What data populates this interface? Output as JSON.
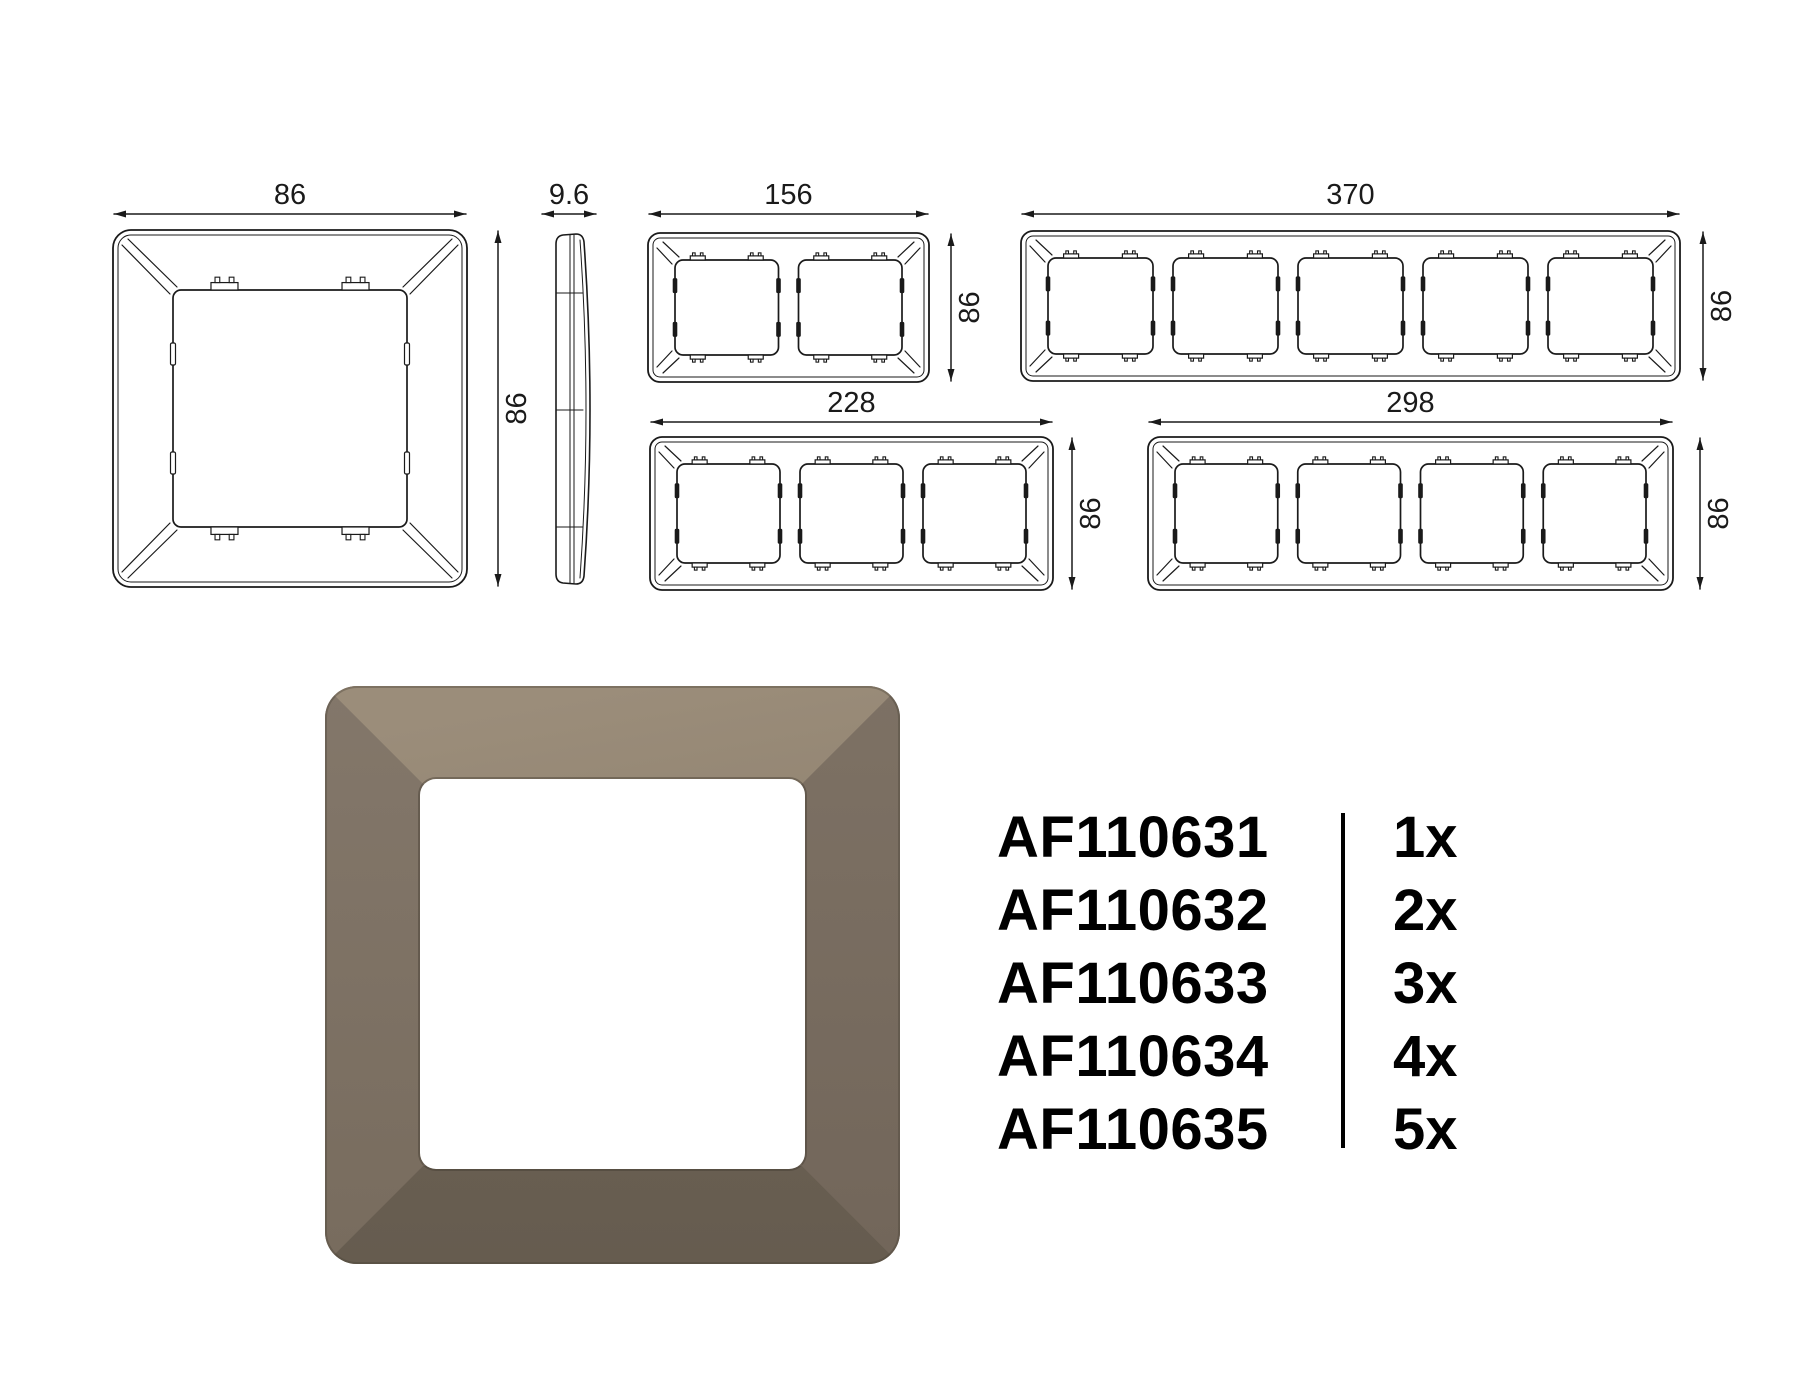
{
  "drawings": {
    "stroke_color": "#1a1a1a",
    "items": [
      {
        "name": "frame-1gang",
        "kind": "frame",
        "gangs": 1,
        "width_label": "86",
        "height_label": "86"
      },
      {
        "name": "side-profile",
        "kind": "profile",
        "gangs": 0,
        "width_label": "9.6",
        "height_label": ""
      },
      {
        "name": "frame-2gang",
        "kind": "frame",
        "gangs": 2,
        "width_label": "156",
        "height_label": "86"
      },
      {
        "name": "frame-5gang",
        "kind": "frame",
        "gangs": 5,
        "width_label": "370",
        "height_label": "86"
      },
      {
        "name": "frame-3gang",
        "kind": "frame",
        "gangs": 3,
        "width_label": "228",
        "height_label": "86"
      },
      {
        "name": "frame-4gang",
        "kind": "frame",
        "gangs": 4,
        "width_label": "298",
        "height_label": "86"
      }
    ]
  },
  "product_list": {
    "rows": [
      {
        "code": "AF110631",
        "qty": "1x"
      },
      {
        "code": "AF110632",
        "qty": "2x"
      },
      {
        "code": "AF110633",
        "qty": "3x"
      },
      {
        "code": "AF110634",
        "qty": "4x"
      },
      {
        "code": "AF110635",
        "qty": "5x"
      }
    ]
  },
  "render": {
    "colors": {
      "top1": "#9b8d7a",
      "top2": "#877a68",
      "left1": "#83776a",
      "left2": "#786c5e",
      "right1": "#7d7164",
      "right2": "#72665a",
      "bottom1": "#70665a",
      "bottom2": "#665c4f",
      "opening": "#ffffff"
    }
  }
}
